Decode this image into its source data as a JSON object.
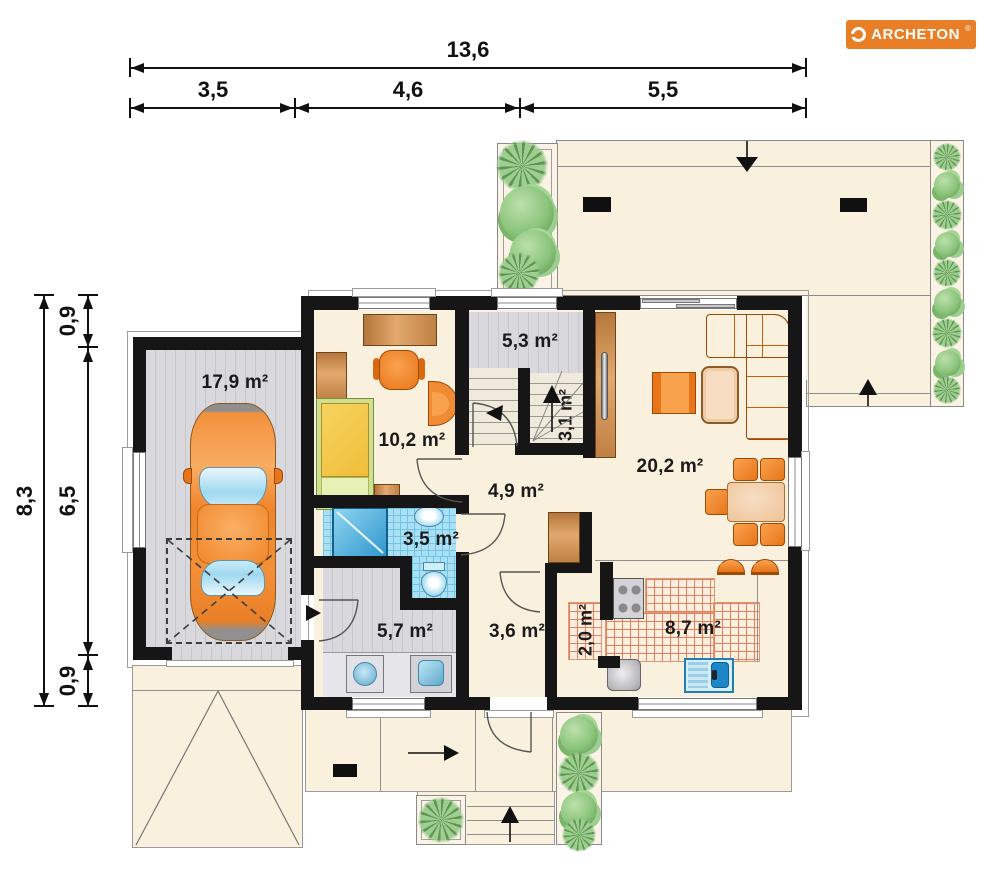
{
  "logo": {
    "brand": "ARCHETON",
    "registered": "®"
  },
  "dimensions": {
    "top_total": "13,6",
    "top_segments": [
      "3,5",
      "4,6",
      "5,5"
    ],
    "left_total": "8,3",
    "left_segments": [
      "0,9",
      "6,5",
      "0,9"
    ]
  },
  "rooms": {
    "garage": "17,9 m²",
    "bedroom": "10,2 m²",
    "hall_upper": "5,3 m²",
    "stairs": "3,1 m²",
    "hall": "4,9 m²",
    "living_room": "20,2 m²",
    "bathroom": "3,5 m²",
    "utility": "5,7 m²",
    "entry_hall": "3,6 m²",
    "pantry": "2,0 m²",
    "kitchen": "8,7 m²"
  },
  "colors": {
    "brand_orange": "#E87E26",
    "wall_black": "#161616",
    "floor_cream": "#FAF0DE",
    "floor_gray": "#D8D8DD",
    "bathroom_blue": "#ABE0F4",
    "kitchen_tile_red": "#E2815C",
    "furniture_orange": "#F08A33",
    "wood_brown": "#C08044",
    "plant_green": "#8CC57C"
  }
}
